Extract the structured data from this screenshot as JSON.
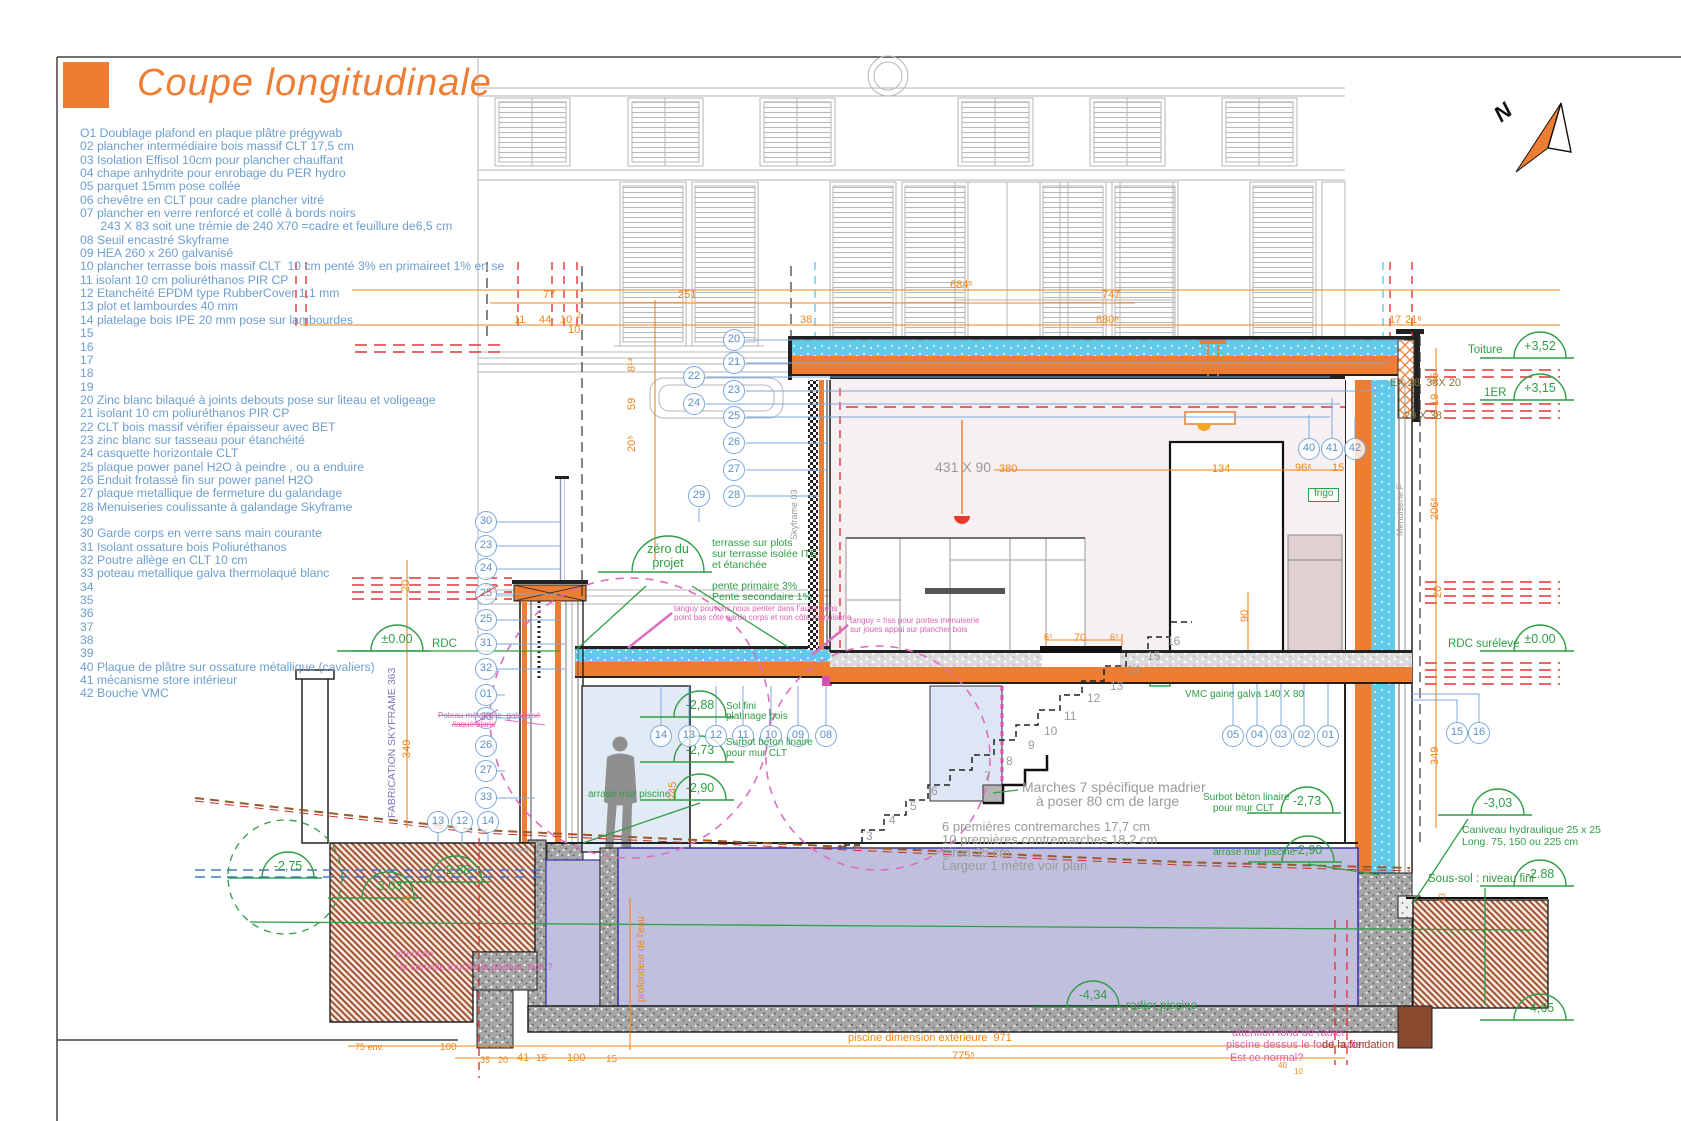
{
  "header": {
    "title": "Coupe longitudinale"
  },
  "north": {
    "label": "N"
  },
  "colors": {
    "accent_orange": "#ED7D31",
    "legend_blue": "#6D9ECE",
    "annotation_green": "#2E9E44",
    "dim_orange": "#F0851A",
    "note_pink": "#E060B0",
    "red_dash": "#E23535",
    "insulation_cyan": "#62C9E9",
    "pool_water": "#C0C0DE"
  },
  "legend": {
    "items": [
      "O1 Doublage plafond en plaque plâtre prégywab",
      "02 plancher intermédiaire bois massif CLT 17,5 cm",
      "03 Isolation Effisol 10cm pour plancher chauffant",
      "04 chape anhydrite pour enrobage du PER hydro",
      "05 parquet 15mm pose collée",
      "06 chevêtre en CLT pour cadre plancher vitré",
      "07 plancher en verre renforcé et collé à bords noirs",
      "      243 X 83 soit une trémie de 240 X70 =cadre et feuillure de6,5 cm",
      "08 Seuil encastré Skyframe",
      "09 HEA 260 x 260 galvanisé",
      "10 plancher terrasse bois massif CLT  10 cm penté 3% en primaireet 1% en se",
      "11 isolant 10 cm poliuréthanos PIR CP",
      "12 Etanchéité EPDM type RubberCover 1,1 mm",
      "13 plot et lambourdes 40 mm",
      "14 platelage bois IPE 20 mm pose sur lambourdes",
      "15",
      "16",
      "17",
      "18",
      "19",
      "20 Zinc blanc bilaqué à joints debouts pose sur liteau et voligeage",
      "21 isolant 10 cm poliuréthanos PIR CP",
      "22 CLT bois massif vérifier épaisseur avec BET",
      "23 zinc blanc sur tasseau pour étanchéité",
      "24 casquette horizontale CLT",
      "25 plaque power panel H2O à peindre , ou a enduire",
      "26 Enduit frotassé fin sur power panel H2O",
      "27 plaque metallique de fermeture du galandage",
      "28 Menuiseries coulissante à galandage Skyframe",
      "29",
      "30 Garde corps en verre sans main courante",
      "31 Isolant ossature bois Poliuréthanos",
      "32 Poutre allège en CLT 10 cm",
      "33 poteau metallique galva thermolaqué blanc",
      "34",
      "35",
      "36",
      "37",
      "38",
      "39",
      "40 Plaque de plâtre sur ossature métallique (cavaliers)",
      "41 mécanisme store intérieur",
      "42 Bouche VMC"
    ]
  },
  "annotations": {
    "balloons": [
      {
        "n": "20",
        "x": 734,
        "y": 340
      },
      {
        "n": "21",
        "x": 734,
        "y": 363
      },
      {
        "n": "22",
        "x": 694,
        "y": 377
      },
      {
        "n": "23",
        "x": 734,
        "y": 391
      },
      {
        "n": "24",
        "x": 694,
        "y": 404
      },
      {
        "n": "25",
        "x": 734,
        "y": 417
      },
      {
        "n": "26",
        "x": 734,
        "y": 443
      },
      {
        "n": "27",
        "x": 734,
        "y": 470
      },
      {
        "n": "28",
        "x": 734,
        "y": 496
      },
      {
        "n": "29",
        "x": 699,
        "y": 496
      },
      {
        "n": "30",
        "x": 486,
        "y": 522
      },
      {
        "n": "23",
        "x": 486,
        "y": 546
      },
      {
        "n": "24",
        "x": 486,
        "y": 569
      },
      {
        "n": "25",
        "x": 486,
        "y": 594,
        "k": 2
      },
      {
        "n": "25",
        "x": 486,
        "y": 620
      },
      {
        "n": "31",
        "x": 486,
        "y": 644
      },
      {
        "n": "32",
        "x": 486,
        "y": 669
      },
      {
        "n": "01",
        "x": 486,
        "y": 695
      },
      {
        "n": "33",
        "x": 486,
        "y": 718,
        "k": 1
      },
      {
        "n": "26",
        "x": 486,
        "y": 746
      },
      {
        "n": "27",
        "x": 486,
        "y": 771
      },
      {
        "n": "33",
        "x": 486,
        "y": 798
      },
      {
        "n": "13",
        "x": 438,
        "y": 822
      },
      {
        "n": "12",
        "x": 462,
        "y": 822
      },
      {
        "n": "14",
        "x": 488,
        "y": 822
      },
      {
        "n": "14",
        "x": 661,
        "y": 736
      },
      {
        "n": "13",
        "x": 689,
        "y": 736
      },
      {
        "n": "12",
        "x": 716,
        "y": 736
      },
      {
        "n": "11",
        "x": 743,
        "y": 736
      },
      {
        "n": "10",
        "x": 771,
        "y": 736
      },
      {
        "n": "09",
        "x": 798,
        "y": 736
      },
      {
        "n": "08",
        "x": 826,
        "y": 736
      },
      {
        "n": "05",
        "x": 1233,
        "y": 736
      },
      {
        "n": "04",
        "x": 1257,
        "y": 736
      },
      {
        "n": "03",
        "x": 1281,
        "y": 736
      },
      {
        "n": "02",
        "x": 1304,
        "y": 736
      },
      {
        "n": "01",
        "x": 1328,
        "y": 736
      },
      {
        "n": "15",
        "x": 1457,
        "y": 733
      },
      {
        "n": "16",
        "x": 1479,
        "y": 733
      },
      {
        "n": "40",
        "x": 1309,
        "y": 449
      },
      {
        "n": "41",
        "x": 1332,
        "y": 449
      },
      {
        "n": "42",
        "x": 1355,
        "y": 449
      }
    ],
    "levels": [
      {
        "v": "+3,52",
        "cx": 1540,
        "y": 358,
        "lab": "Toiture",
        "labx": 1468,
        "laby": 344
      },
      {
        "v": "+3,15",
        "cx": 1540,
        "y": 400,
        "lab": "1ER",
        "labx": 1484,
        "laby": 387
      },
      {
        "v": "±0.00",
        "cx": 1540,
        "y": 651,
        "lab": "RDC surélevé",
        "labx": 1448,
        "laby": 638
      },
      {
        "v": "-3,03",
        "cx": 1498,
        "y": 815,
        "sub": [
          [
            "Caniveau hydraulique 25 x 25",
            1462,
            825
          ],
          [
            "Long. 75, 150 ou 225 cm",
            1462,
            837
          ]
        ]
      },
      {
        "v": "-2.88",
        "cx": 1540,
        "y": 886,
        "lab": "Sous-sol : niveau fini",
        "labx": 1428,
        "laby": 873
      },
      {
        "v": "±0.00",
        "cx": 397,
        "y": 651,
        "lab": "RDC",
        "labx": 432,
        "laby": 638
      },
      {
        "v": "zéro du",
        "v2": "projet",
        "cx": 668,
        "y": 572,
        "r": 36
      },
      {
        "v": "-2,88",
        "cx": 700,
        "y": 717
      },
      {
        "v": "-2,73",
        "cx": 700,
        "y": 762
      },
      {
        "v": "-2,90",
        "cx": 700,
        "y": 800
      },
      {
        "v": "-2,73",
        "cx": 1307,
        "y": 813
      },
      {
        "v": "-2,90",
        "cx": 1308,
        "y": 862
      },
      {
        "v": "-4,34",
        "cx": 1093,
        "y": 1007
      },
      {
        "v": "-2.88",
        "cx": 456,
        "y": 882
      },
      {
        "v": "-3,03",
        "cx": 388,
        "y": 898
      },
      {
        "v": "-2,75",
        "cx": 288,
        "y": 878
      },
      {
        "v": "-4,65",
        "cx": 1540,
        "y": 1020
      }
    ],
    "texts": [
      {
        "t": "77",
        "x": 543,
        "y": 290,
        "c": "o"
      },
      {
        "t": "251",
        "x": 678,
        "y": 290,
        "c": "o"
      },
      {
        "t": "684⁵",
        "x": 950,
        "y": 280,
        "c": "o"
      },
      {
        "t": "747",
        "x": 1102,
        "y": 290,
        "c": "o"
      },
      {
        "t": "680⁶",
        "x": 1096,
        "y": 315,
        "c": "o"
      },
      {
        "t": "11",
        "x": 514,
        "y": 315,
        "c": "o"
      },
      {
        "t": "44",
        "x": 539,
        "y": 315,
        "c": "o"
      },
      {
        "t": "10",
        "x": 560,
        "y": 315,
        "c": "o"
      },
      {
        "t": "2",
        "x": 576,
        "y": 311,
        "c": "o",
        "s": 9
      },
      {
        "t": "10",
        "x": 568,
        "y": 325,
        "c": "o"
      },
      {
        "t": "38",
        "x": 800,
        "y": 315,
        "c": "o"
      },
      {
        "t": "17",
        "x": 1389,
        "y": 315,
        "c": "o"
      },
      {
        "t": "21⁶",
        "x": 1405,
        "y": 315,
        "c": "o"
      },
      {
        "t": "45",
        "x": 1430,
        "y": 385,
        "c": "o",
        "r": 1
      },
      {
        "t": "19",
        "x": 1430,
        "y": 406,
        "c": "o",
        "r": 1
      },
      {
        "t": "206⁶",
        "x": 1430,
        "y": 520,
        "c": "o",
        "r": 1
      },
      {
        "t": "20",
        "x": 1433,
        "y": 598,
        "c": "o",
        "r": 1
      },
      {
        "t": "349",
        "x": 1430,
        "y": 765,
        "c": "o",
        "r": 1
      },
      {
        "t": "349",
        "x": 402,
        "y": 758,
        "c": "o",
        "r": 1
      },
      {
        "t": "20",
        "x": 401,
        "y": 592,
        "c": "o",
        "r": 1
      },
      {
        "t": "8¹⁴",
        "x": 627,
        "y": 372,
        "c": "o",
        "r": 1
      },
      {
        "t": "59",
        "x": 627,
        "y": 410,
        "c": "o",
        "r": 1
      },
      {
        "t": "20⁵",
        "x": 627,
        "y": 452,
        "c": "o",
        "r": 1
      },
      {
        "t": "245",
        "x": 668,
        "y": 800,
        "c": "o",
        "r": 1
      },
      {
        "t": "6⁵",
        "x": 1044,
        "y": 633,
        "c": "o",
        "s": 9
      },
      {
        "t": "70",
        "x": 1074,
        "y": 633,
        "c": "o"
      },
      {
        "t": "6⁵",
        "x": 1110,
        "y": 633,
        "c": "o",
        "s": 9
      },
      {
        "t": "90",
        "x": 1240,
        "y": 622,
        "c": "o",
        "r": 1
      },
      {
        "t": "380",
        "x": 999,
        "y": 464,
        "c": "o"
      },
      {
        "t": "134",
        "x": 1212,
        "y": 464,
        "c": "o"
      },
      {
        "t": "96⁶",
        "x": 1295,
        "y": 463,
        "c": "o"
      },
      {
        "t": "15",
        "x": 1332,
        "y": 463,
        "c": "o"
      },
      {
        "t": "15",
        "x": 1356,
        "y": 467,
        "c": "o"
      },
      {
        "t": "4 m",
        "x": 1362,
        "y": 516,
        "c": "o",
        "r": 1,
        "s": 9
      },
      {
        "t": "15",
        "x": 403,
        "y": 905,
        "c": "o",
        "r": 1,
        "s": 9
      },
      {
        "t": "13",
        "x": 1438,
        "y": 903,
        "c": "o",
        "r": 1,
        "s": 9
      },
      {
        "t": "75 env.",
        "x": 355,
        "y": 1043,
        "c": "o",
        "s": 9
      },
      {
        "t": "100",
        "x": 440,
        "y": 1043,
        "c": "o",
        "s": 10
      },
      {
        "t": "35",
        "x": 480,
        "y": 1056,
        "c": "o",
        "s": 9
      },
      {
        "t": "20",
        "x": 498,
        "y": 1056,
        "c": "o",
        "s": 9
      },
      {
        "t": "41",
        "x": 517,
        "y": 1053,
        "c": "o"
      },
      {
        "t": "15",
        "x": 536,
        "y": 1054,
        "c": "o",
        "s": 10
      },
      {
        "t": "100",
        "x": 567,
        "y": 1053,
        "c": "o"
      },
      {
        "t": "15",
        "x": 606,
        "y": 1055,
        "c": "o",
        "s": 10
      },
      {
        "t": "775⁵",
        "x": 952,
        "y": 1051,
        "c": "o"
      },
      {
        "t": "piscine dimension extérieure  971",
        "x": 848,
        "y": 1033,
        "c": "o"
      },
      {
        "t": "profondeur de l'eau",
        "x": 637,
        "y": 1002,
        "c": "o",
        "r": 1,
        "s": 10
      },
      {
        "t": "40",
        "x": 1278,
        "y": 1062,
        "c": "o",
        "s": 8
      },
      {
        "t": "10",
        "x": 1294,
        "y": 1068,
        "c": "o",
        "s": 8
      },
      {
        "t": "EX 28  38X 20",
        "x": 1390,
        "y": 378,
        "c": "ol",
        "s": 11
      },
      {
        "t": "20 X 38",
        "x": 1404,
        "y": 411,
        "c": "ol",
        "s": 11
      },
      {
        "t": "431 X 90",
        "x": 935,
        "y": 460,
        "c": "g",
        "s": 14
      },
      {
        "t": "Marches 7 spécifique madrier",
        "x": 1022,
        "y": 780,
        "c": "g",
        "s": 14
      },
      {
        "t": "à poser 80 cm de large",
        "x": 1036,
        "y": 794,
        "c": "g",
        "s": 14
      },
      {
        "t": "6 premières contremarches 17,7 cm",
        "x": 942,
        "y": 820,
        "c": "g",
        "s": 13
      },
      {
        "t": "10 premières contremarches 18,2 cm",
        "x": 942,
        "y": 833,
        "c": "g",
        "s": 13
      },
      {
        "t": "giron 25 cm",
        "x": 942,
        "y": 846,
        "c": "g",
        "s": 13
      },
      {
        "t": "Largeur 1 mètre voir plan",
        "x": 942,
        "y": 859,
        "c": "g",
        "s": 13
      },
      {
        "t": "Menuiserie F",
        "x": 1396,
        "y": 536,
        "c": "g",
        "r": 1,
        "s": 9
      },
      {
        "t": "Skyframe 03",
        "x": 790,
        "y": 540,
        "c": "g",
        "r": 1,
        "s": 9
      },
      {
        "t": "REGARD",
        "x": 509,
        "y": 849,
        "c": "g",
        "s": 5
      },
      {
        "t": "3",
        "x": 866,
        "y": 830,
        "c": "g",
        "s": 12
      },
      {
        "t": "4",
        "x": 889,
        "y": 814,
        "c": "g",
        "s": 12
      },
      {
        "t": "5",
        "x": 910,
        "y": 800,
        "c": "g",
        "s": 12
      },
      {
        "t": "6",
        "x": 931,
        "y": 785,
        "c": "g",
        "s": 12
      },
      {
        "t": "7",
        "x": 984,
        "y": 770,
        "c": "g",
        "s": 12
      },
      {
        "t": "8",
        "x": 1006,
        "y": 755,
        "c": "g",
        "s": 12
      },
      {
        "t": "9",
        "x": 1028,
        "y": 739,
        "c": "g",
        "s": 12
      },
      {
        "t": "10",
        "x": 1044,
        "y": 725,
        "c": "g",
        "s": 12
      },
      {
        "t": "11",
        "x": 1064,
        "y": 710,
        "c": "g",
        "s": 12
      },
      {
        "t": "12",
        "x": 1087,
        "y": 692,
        "c": "g",
        "s": 12
      },
      {
        "t": "13",
        "x": 1110,
        "y": 680,
        "c": "g",
        "s": 12
      },
      {
        "t": "14",
        "x": 1127,
        "y": 664,
        "c": "g",
        "s": 12
      },
      {
        "t": "15",
        "x": 1147,
        "y": 650,
        "c": "g",
        "s": 12
      },
      {
        "t": "16",
        "x": 1167,
        "y": 635,
        "c": "g",
        "s": 12
      },
      {
        "t": "terrasse sur plots",
        "x": 712,
        "y": 538,
        "c": "gr",
        "s": 10.5
      },
      {
        "t": "sur terrasse isolée ITE",
        "x": 712,
        "y": 549,
        "c": "gr",
        "s": 10.5
      },
      {
        "t": "et étanchée",
        "x": 712,
        "y": 560,
        "c": "gr",
        "s": 10.5
      },
      {
        "t": "pente primaire 3%",
        "x": 712,
        "y": 581,
        "c": "gr",
        "s": 10.5
      },
      {
        "t": "Pente secondaire 1%",
        "x": 712,
        "y": 592,
        "c": "gr",
        "s": 10.5
      },
      {
        "t": "VMC gaine galva 140 X 80",
        "x": 1185,
        "y": 690,
        "c": "gr",
        "s": 10
      },
      {
        "t": "radier piscine",
        "x": 1126,
        "y": 999,
        "c": "gr",
        "s": 12
      },
      {
        "t": "Sol fini",
        "x": 726,
        "y": 702,
        "c": "gr",
        "s": 10
      },
      {
        "t": "platinage bois",
        "x": 726,
        "y": 712,
        "c": "gr",
        "s": 10
      },
      {
        "t": "Surbot béton linaire",
        "x": 726,
        "y": 738,
        "c": "gr",
        "s": 10
      },
      {
        "t": "pour mur CLT",
        "x": 726,
        "y": 749,
        "c": "gr",
        "s": 10
      },
      {
        "t": "arrase mur piscine",
        "x": 588,
        "y": 790,
        "c": "gr",
        "s": 10
      },
      {
        "t": "Surbot béton linaire",
        "x": 1203,
        "y": 793,
        "c": "gr",
        "s": 10
      },
      {
        "t": "pour mur CLT",
        "x": 1213,
        "y": 804,
        "c": "gr",
        "s": 10
      },
      {
        "t": "arrase mur piscine",
        "x": 1213,
        "y": 848,
        "c": "gr",
        "s": 10
      },
      {
        "t": "frigo",
        "x": 1308,
        "y": 488,
        "c": "gr",
        "s": 10,
        "box": 1
      },
      {
        "t": "tanguy pouvons nous penter dans l'autre sens",
        "x": 674,
        "y": 605,
        "c": "p",
        "s": 8
      },
      {
        "t": "point bas côté garde corps et non côté menuiserie",
        "x": 674,
        "y": 614,
        "c": "p",
        "s": 8
      },
      {
        "t": "tanguy = hss pour portes menuiserie",
        "x": 850,
        "y": 617,
        "c": "p",
        "s": 8
      },
      {
        "t": "sur joues appui sur plancher bois",
        "x": 850,
        "y": 626,
        "c": "p",
        "s": 8
      },
      {
        "t": "Poteau métallique  galvanisé",
        "x": 438,
        "y": 712,
        "c": "p",
        "s": 8,
        "k": 1
      },
      {
        "t": "/laqué blanc",
        "x": 452,
        "y": 721,
        "c": "p",
        "s": 8,
        "k": 1
      },
      {
        "t": "attention",
        "x": 395,
        "y": 950,
        "c": "p",
        "s": 10
      },
      {
        "t": "la semelle touche la piscine, non ?",
        "x": 400,
        "y": 963,
        "c": "p",
        "s": 10
      },
      {
        "t": "attention fond de radier",
        "x": 1232,
        "y": 1028,
        "c": "p",
        "s": 11
      },
      {
        "t": "piscine dessus le fond radier",
        "x": 1226,
        "y": 1040,
        "c": "p",
        "s": 11
      },
      {
        "t": "Est ce normal?",
        "x": 1230,
        "y": 1053,
        "c": "p",
        "s": 11
      },
      {
        "t": "de la fondation",
        "x": 1322,
        "y": 1040,
        "c": "dr",
        "s": 11
      },
      {
        "t": "FABRICATION SKYFRAME 363",
        "x": 387,
        "y": 818,
        "c": "pu",
        "r": 1,
        "s": 10.5
      }
    ]
  }
}
